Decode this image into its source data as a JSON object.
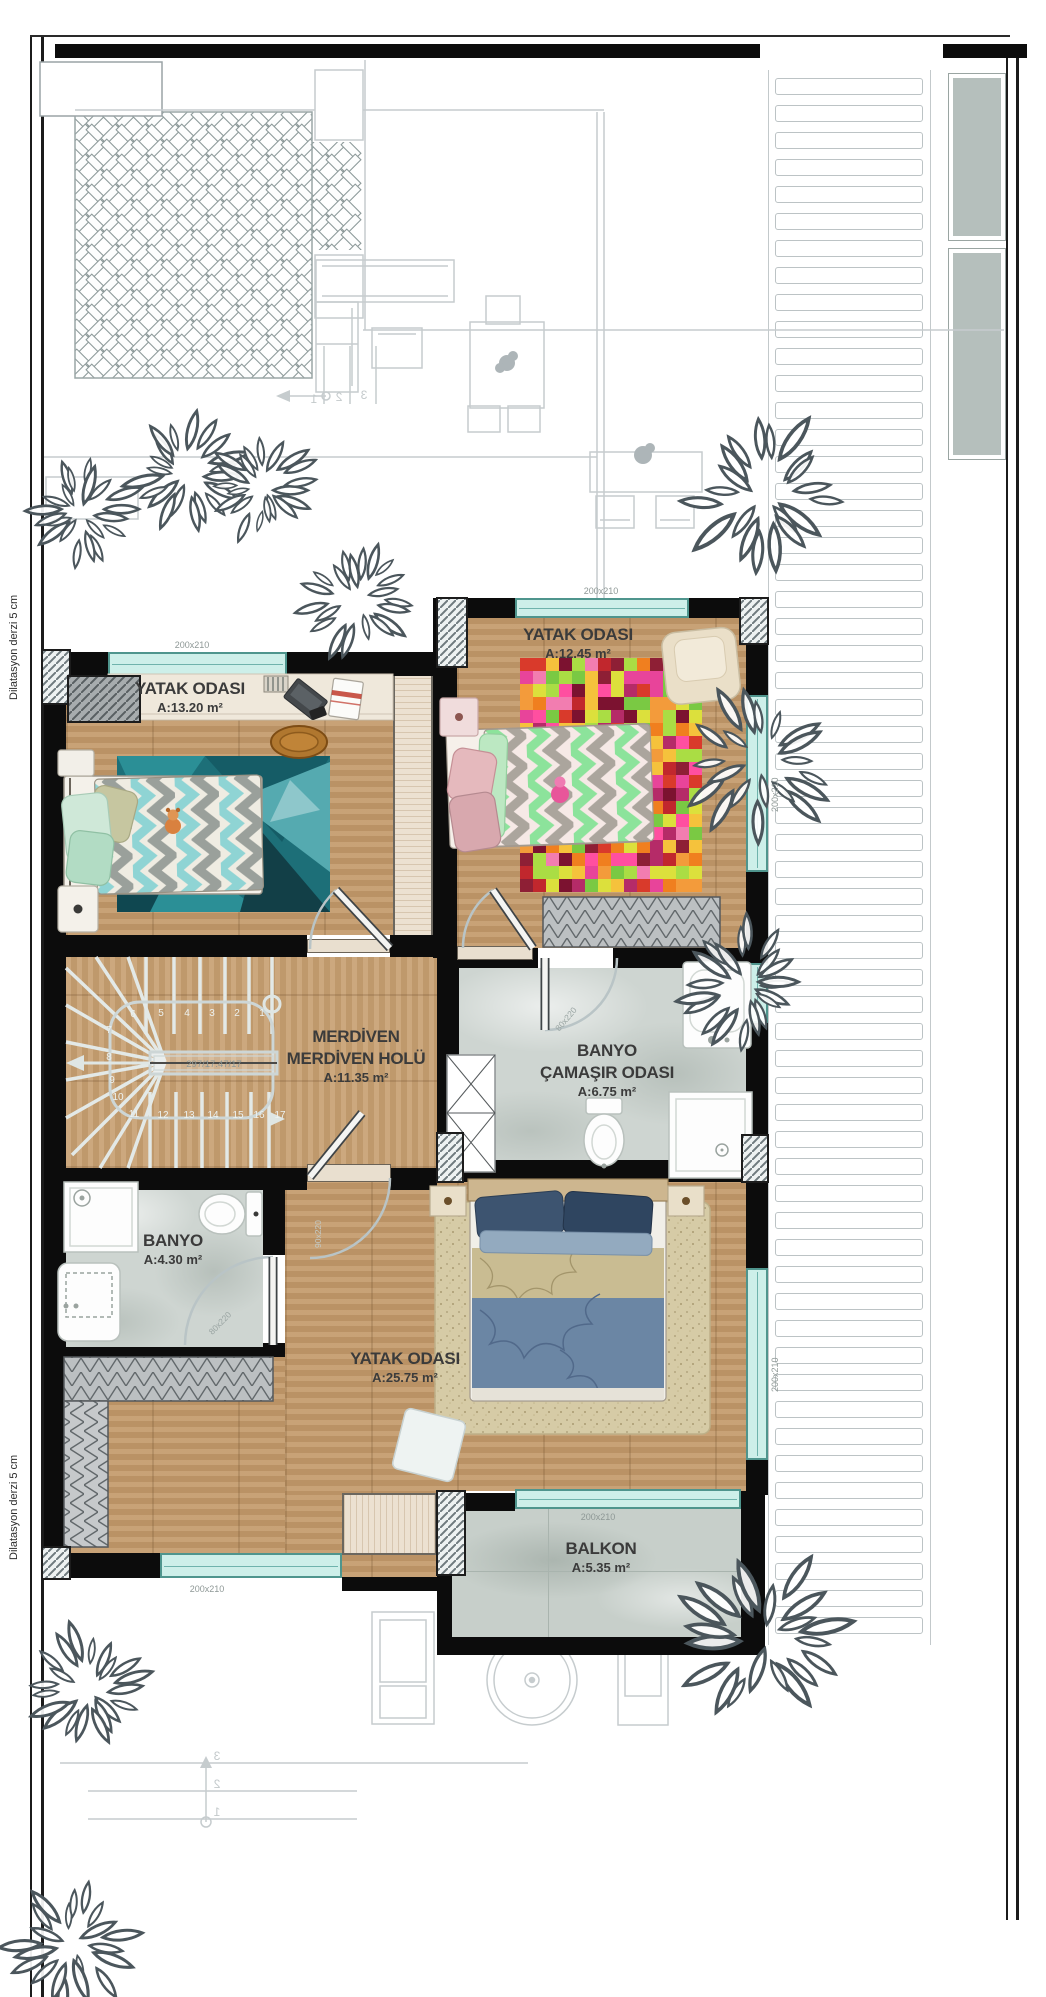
{
  "plan": {
    "margin_note_top": "Dilatasyon derzi 5 cm",
    "margin_note_bottom": "Dilatasyon derzi 5 cm",
    "rooms": [
      {
        "name": "YATAK ODASI",
        "area": "A:13.20 m²"
      },
      {
        "name": "YATAK ODASI",
        "area": "A:12.45 m²"
      },
      {
        "name": "MERDİVEN",
        "name2": "MERDİVEN HOLÜ",
        "area": "A:11.35 m²"
      },
      {
        "name": "BANYO",
        "name2": "ÇAMAŞIR ODASI",
        "area": "A:6.75 m²"
      },
      {
        "name": "BANYO",
        "area": "A:4.30 m²"
      },
      {
        "name": "YATAK ODASI",
        "area": "A:25.75 m²"
      },
      {
        "name": "BALKON",
        "area": "A:5.35 m²"
      }
    ],
    "dims": {
      "window": "200x210",
      "door_small": "80x220",
      "door_large": "90x220"
    },
    "stairs": {
      "center_label": "297/17.47/17",
      "step_numbers": [
        "1",
        "2",
        "3",
        "4",
        "5",
        "6",
        "7",
        "8",
        "9",
        "10",
        "11",
        "12",
        "13",
        "14",
        "15",
        "16",
        "17"
      ],
      "ghost_step_numbers": [
        "1",
        "2",
        "3"
      ]
    },
    "colors": {
      "wall": "#0c0c0c",
      "glass": "#cdefe9",
      "glass_frame": "#4f958d",
      "wood": "#c39a6b",
      "marble": "#ced5d1",
      "ghost": "#c6ccce",
      "tree": "#4b565c",
      "pixel_rug_palette": [
        "#d93a2b",
        "#f39b3b",
        "#e8449a",
        "#8e1f35",
        "#7ac943",
        "#f27db0",
        "#c1272d",
        "#aadd44",
        "#ff4fa0",
        "#7c1230",
        "#f07f1f",
        "#b52b68",
        "#dce03c",
        "#f5c23c"
      ]
    }
  }
}
